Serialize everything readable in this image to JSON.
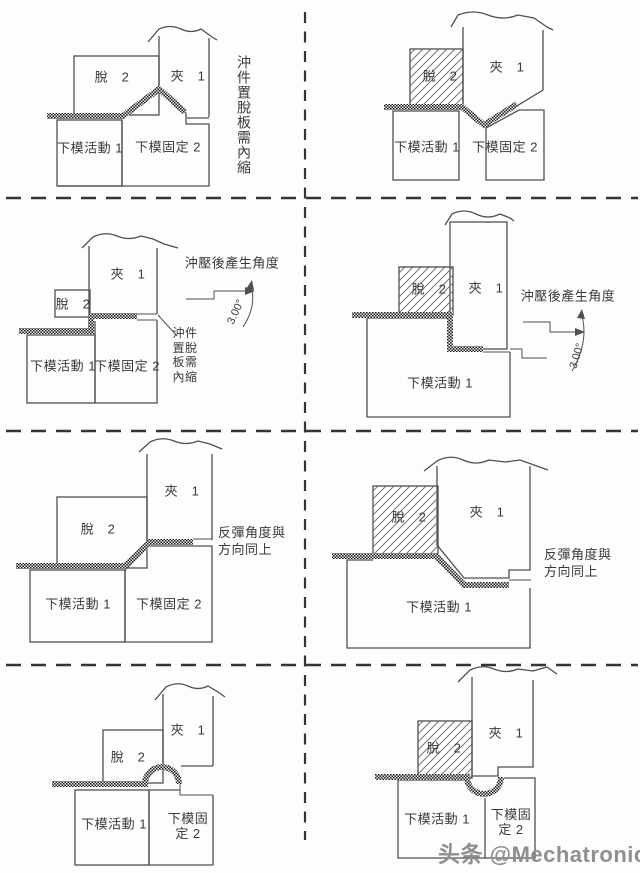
{
  "labels": {
    "clamp": "夾　1",
    "stripper": "脫　2",
    "lower_movable": "下模活動 1",
    "lower_fixed": "下模固定 2",
    "lower_fixed_wrapped": "下模固\n定 2"
  },
  "notes": {
    "r1_inward": "沖件置脫板需內縮",
    "r2_angle": "沖壓後產生角度",
    "r2_inward_wrapped": "沖件\n置脫\n板需\n內縮",
    "angle_value": "3.00°",
    "r3_springback": "反彈角度與\n方向同上"
  },
  "watermark": "头条 @Mechatronics",
  "colors": {
    "outline": "#4f4f4f",
    "text": "#3a3a3a",
    "metal": "#1a1a1a",
    "hatch": "#777777",
    "divider": "#343434",
    "watermark": "#8f8f8f",
    "background": "#fdfdfd"
  }
}
